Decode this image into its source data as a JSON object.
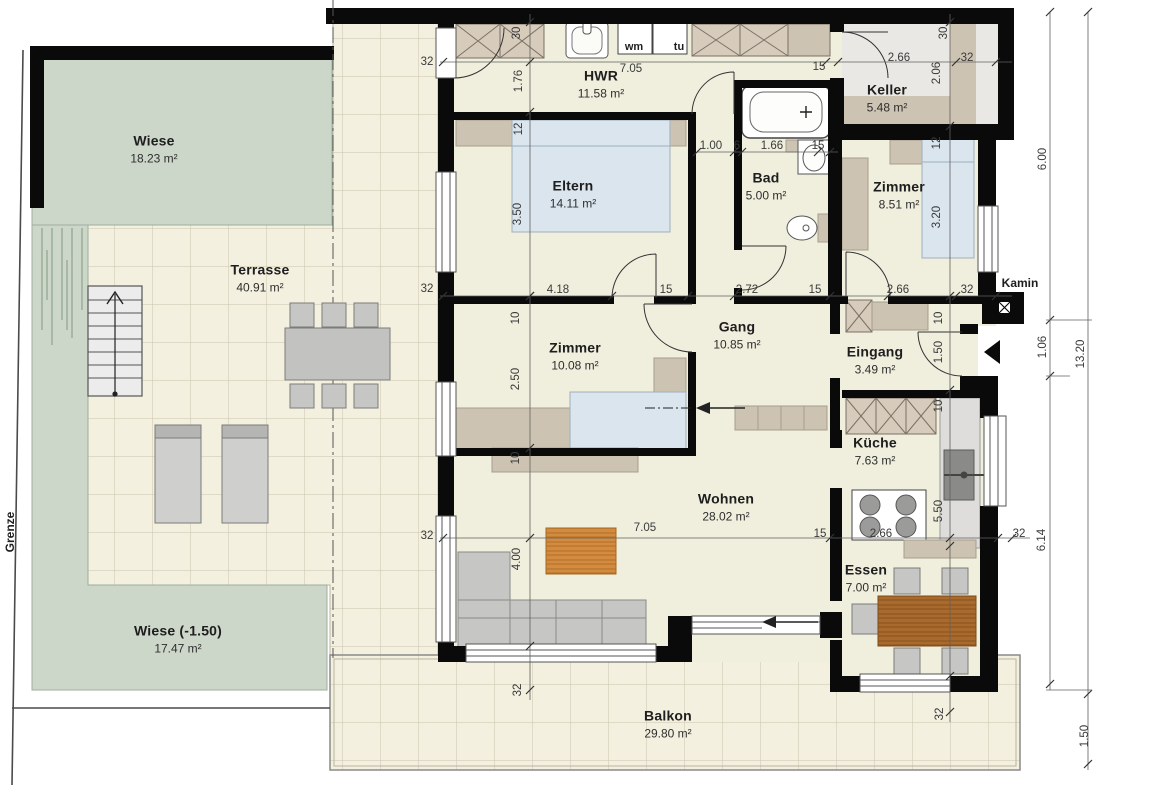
{
  "outdoor": {
    "wiese_top": {
      "name": "Wiese",
      "area": "18.23 m²"
    },
    "terrasse": {
      "name": "Terrasse",
      "area": "40.91 m²"
    },
    "wiese_bottom": {
      "name": "Wiese (-1.50)",
      "area": "17.47 m²"
    },
    "balkon": {
      "name": "Balkon",
      "area": "29.80 m²"
    },
    "grenze_label": "Grenze"
  },
  "rooms": {
    "hwr": {
      "name": "HWR",
      "area": "11.58 m²"
    },
    "keller": {
      "name": "Keller",
      "area": "5.48 m²"
    },
    "eltern": {
      "name": "Eltern",
      "area": "14.11 m²"
    },
    "bad": {
      "name": "Bad",
      "area": "5.00 m²"
    },
    "zimmer1": {
      "name": "Zimmer",
      "area": "8.51 m²"
    },
    "gang": {
      "name": "Gang",
      "area": "10.85 m²"
    },
    "eingang": {
      "name": "Eingang",
      "area": "3.49 m²"
    },
    "zimmer2": {
      "name": "Zimmer",
      "area": "10.08 m²"
    },
    "kueche": {
      "name": "Küche",
      "area": "7.63 m²"
    },
    "wohnen": {
      "name": "Wohnen",
      "area": "28.02 m²"
    },
    "essen": {
      "name": "Essen",
      "area": "7.00 m²"
    }
  },
  "appliances": {
    "wm": "wm",
    "tu": "tu"
  },
  "kamin_label": "Kamin",
  "colors": {
    "wall": "#0a0a0a",
    "floor": "#f0eedd",
    "tile": "#f3f0df",
    "tile_line": "#c9c4ad",
    "grass": "#ccd7ca",
    "tan": "#cdc3b2",
    "bed_blue": "#dae5ee",
    "wood": "#d28b3f",
    "wood_dark": "#a96a2e",
    "furniture_gray": "#c6c6c4"
  },
  "dimensions": [
    {
      "t": "32",
      "x": 427,
      "y": 62,
      "v": false
    },
    {
      "t": "30",
      "x": 517,
      "y": 33,
      "v": true
    },
    {
      "t": "1.76",
      "x": 519,
      "y": 81,
      "v": true
    },
    {
      "t": "7.05",
      "x": 631,
      "y": 69,
      "v": false
    },
    {
      "t": "15",
      "x": 819,
      "y": 67,
      "v": false
    },
    {
      "t": "2.66",
      "x": 899,
      "y": 58,
      "v": false
    },
    {
      "t": "32",
      "x": 967,
      "y": 58,
      "v": false
    },
    {
      "t": "30",
      "x": 944,
      "y": 33,
      "v": true
    },
    {
      "t": "2.06",
      "x": 937,
      "y": 73,
      "v": true
    },
    {
      "t": "12",
      "x": 519,
      "y": 129,
      "v": true
    },
    {
      "t": "3.50",
      "x": 518,
      "y": 214,
      "v": true
    },
    {
      "t": "1.00",
      "x": 711,
      "y": 146,
      "v": false
    },
    {
      "t": "6",
      "x": 737,
      "y": 146,
      "v": false
    },
    {
      "t": "1.66",
      "x": 772,
      "y": 146,
      "v": false
    },
    {
      "t": "15",
      "x": 818,
      "y": 146,
      "v": false
    },
    {
      "t": "12",
      "x": 937,
      "y": 143,
      "v": true
    },
    {
      "t": "3.20",
      "x": 937,
      "y": 217,
      "v": true
    },
    {
      "t": "32",
      "x": 427,
      "y": 289,
      "v": false
    },
    {
      "t": "4.18",
      "x": 558,
      "y": 290,
      "v": false
    },
    {
      "t": "15",
      "x": 666,
      "y": 290,
      "v": false
    },
    {
      "t": "2.72",
      "x": 747,
      "y": 290,
      "v": false
    },
    {
      "t": "15",
      "x": 815,
      "y": 290,
      "v": false
    },
    {
      "t": "2.66",
      "x": 898,
      "y": 290,
      "v": false
    },
    {
      "t": "32",
      "x": 967,
      "y": 290,
      "v": false
    },
    {
      "t": "10",
      "x": 516,
      "y": 318,
      "v": true
    },
    {
      "t": "2.50",
      "x": 516,
      "y": 379,
      "v": true
    },
    {
      "t": "10",
      "x": 516,
      "y": 458,
      "v": true
    },
    {
      "t": "10",
      "x": 939,
      "y": 318,
      "v": true
    },
    {
      "t": "1.50",
      "x": 939,
      "y": 352,
      "v": true
    },
    {
      "t": "10",
      "x": 939,
      "y": 406,
      "v": true
    },
    {
      "t": "5.50",
      "x": 939,
      "y": 511,
      "v": true
    },
    {
      "t": "4.00",
      "x": 517,
      "y": 559,
      "v": true
    },
    {
      "t": "7.05",
      "x": 645,
      "y": 528,
      "v": false
    },
    {
      "t": "15",
      "x": 820,
      "y": 534,
      "v": false
    },
    {
      "t": "2.66",
      "x": 881,
      "y": 534,
      "v": false
    },
    {
      "t": "32",
      "x": 1019,
      "y": 534,
      "v": false
    },
    {
      "t": "32",
      "x": 427,
      "y": 536,
      "v": false
    },
    {
      "t": "32",
      "x": 518,
      "y": 690,
      "v": true
    },
    {
      "t": "32",
      "x": 940,
      "y": 714,
      "v": true
    },
    {
      "t": "6.00",
      "x": 1043,
      "y": 159,
      "v": true
    },
    {
      "t": "1.06",
      "x": 1043,
      "y": 347,
      "v": true
    },
    {
      "t": "6.14",
      "x": 1042,
      "y": 540,
      "v": true
    },
    {
      "t": "13.20",
      "x": 1081,
      "y": 354,
      "v": true
    },
    {
      "t": "1.50",
      "x": 1085,
      "y": 736,
      "v": true
    }
  ]
}
